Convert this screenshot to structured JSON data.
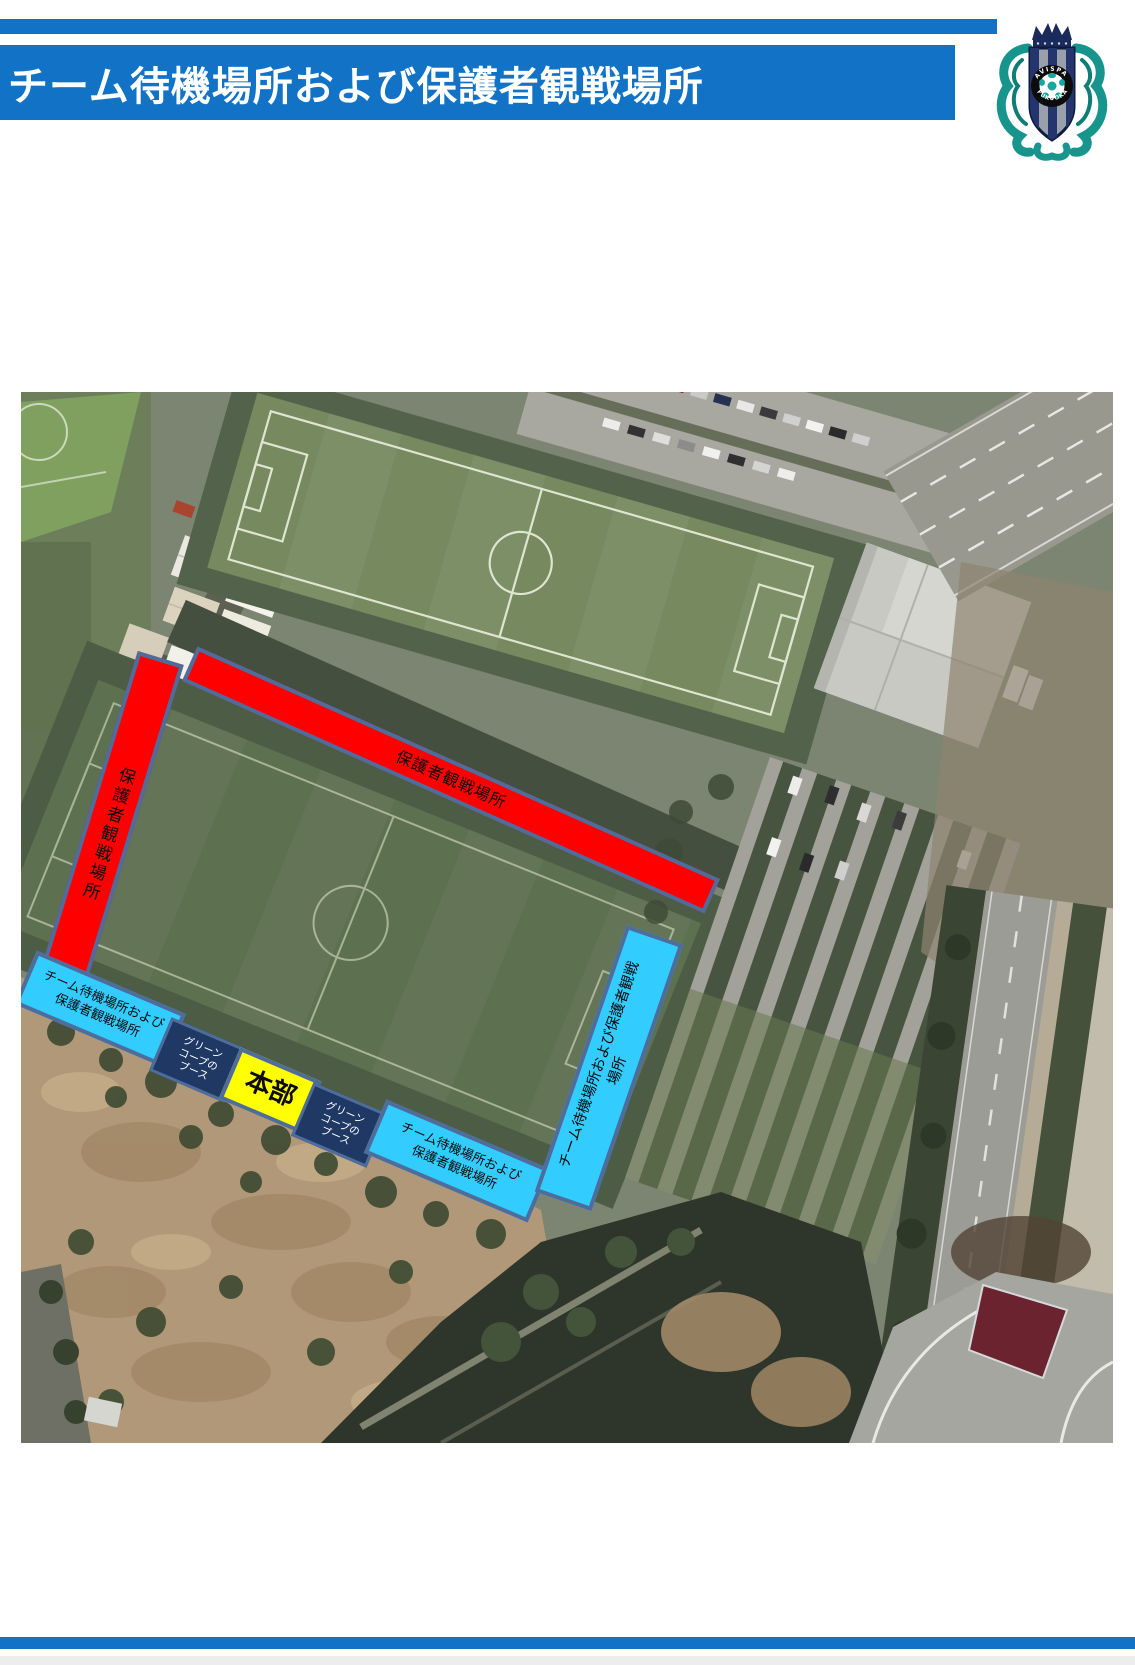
{
  "header": {
    "title": "チーム待機場所および保護者観戦場所",
    "bar_color": "#1273C6",
    "logo": {
      "name": "Avispa Fukuoka crest",
      "arc_text_top": "AVISPA",
      "arc_text_bottom": "FUKUOKA"
    }
  },
  "map": {
    "type": "satellite-aerial-view",
    "zones": {
      "spectator_left_bar": {
        "label": "保護者観戦場所",
        "fill": "#FF0000",
        "border": "#4E6D9C",
        "text_color": "#000000"
      },
      "spectator_top_bar": {
        "label": "保護者観戦場所",
        "fill": "#FF0000",
        "border": "#4E6D9C",
        "text_color": "#000000"
      },
      "team_wait_left": {
        "line1": "チーム待機場所および",
        "line2": "保護者観戦場所",
        "fill": "#33CCFF",
        "text_color": "#000000"
      },
      "green_coop_booth_1": {
        "line1": "グリーン",
        "line2": "コープの",
        "line3": "ブース",
        "fill": "#1F3864",
        "text_color": "#FFFFFF"
      },
      "headquarters": {
        "label": "本部",
        "fill": "#FFFF00",
        "text_color": "#000000"
      },
      "green_coop_booth_2": {
        "line1": "グリーン",
        "line2": "コープの",
        "line3": "ブース",
        "fill": "#1F3864",
        "text_color": "#FFFFFF"
      },
      "team_wait_bottom": {
        "line1": "チーム待機場所および",
        "line2": "保護者観戦場所",
        "fill": "#33CCFF",
        "text_color": "#000000"
      },
      "team_wait_right": {
        "line1": "チーム待機場所および保護者観戦",
        "line2": "場所",
        "fill": "#33CCFF",
        "text_color": "#000000"
      }
    }
  },
  "footer": {
    "bar_color": "#1273C6"
  }
}
